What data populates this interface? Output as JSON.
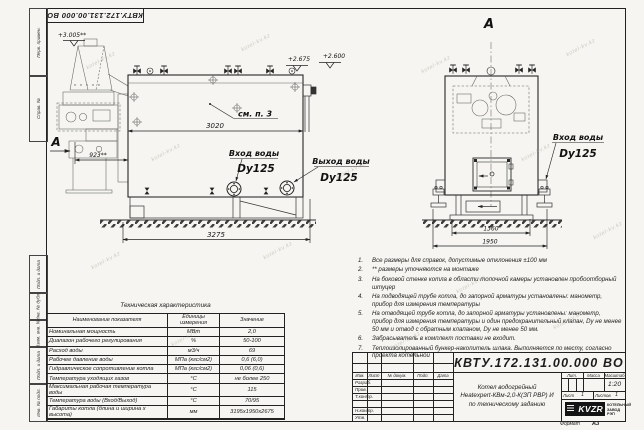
{
  "watermark": "kotel-kv.kz",
  "frame": {
    "left_labels": [
      "Перв. примен.",
      "Справ. №",
      "Подп. и дата",
      "Инв. № дубл.",
      "Взам. инв. №",
      "Подп. и дата",
      "Инв. № подл."
    ],
    "format_label": "Формат",
    "format_value": "А3"
  },
  "views": {
    "left": {
      "view_letter": "А",
      "dim_length": "3020",
      "dim_total": "3275",
      "dim_burner": "923**",
      "elev_hopper": "+3.005**",
      "elev_top": "+2.675",
      "elev_top2": "+2.600",
      "note_ref": "см. п. 3",
      "inlet": "Вход воды",
      "inlet_dn": "Dy125",
      "outlet": "Выход воды",
      "outlet_dn": "Dy125"
    },
    "right": {
      "title": "А",
      "dim_base": "1360",
      "dim_width": "1950",
      "inlet": "Вход воды",
      "inlet_dn": "Dy125"
    }
  },
  "notes": {
    "items": [
      {
        "num": "1.",
        "text": "Все размеры для справок, допустимые отклонения ±100 мм"
      },
      {
        "num": "2.",
        "text": "** размеры уточняются на монтаже"
      },
      {
        "num": "3.",
        "text": "На боковой стенке котла в области топочной камеры установлен пробоотборный штуцер"
      },
      {
        "num": "4.",
        "text": "На подводящей трубе котла, до запорной арматуры установлены: манометр, прибор для измерения температуры"
      },
      {
        "num": "5.",
        "text": "На отводящей трубе котла, до запорной арматуры установлены: манометр, прибор для измерения температуры и один предохранительный клапан, Dy не менее 50 мм и отвод с обратным клапаном, Dy не менее 50 мм."
      },
      {
        "num": "6.",
        "text": "Забрасыватель в комплект поставки не входит."
      },
      {
        "num": "7.",
        "text": "Теплоизолированный бункер-накопитель шлака. Выполняется по месту, согласно проекта котельной"
      }
    ]
  },
  "tech_table": {
    "title": "Техническая характеристика",
    "headers": [
      "Наименование показателя",
      "Единицы измерения",
      "Значение"
    ],
    "rows": [
      {
        "name": "Номинальная мощность",
        "unit": "МВт",
        "value": "2,0"
      },
      {
        "name": "Диапазон рабочего регулирования",
        "unit": "%",
        "value": "50-100"
      },
      {
        "name": "Расход воды",
        "unit": "м3/ч",
        "value": "69"
      },
      {
        "name": "Рабочее давление воды",
        "unit": "МПа (кгс/см2)",
        "value": "0,6 (6,0)"
      },
      {
        "name": "Гидравлическое сопротивление котла",
        "unit": "МПа (кгс/см2)",
        "value": "0,06 (0,6)"
      },
      {
        "name": "Температура уходящих газов",
        "unit": "°С",
        "value": "не более 250"
      },
      {
        "name": "Максимальная рабочая температура воды",
        "unit": "°С",
        "value": "115"
      },
      {
        "name": "Температура воды (Вход/Выход)",
        "unit": "°С",
        "value": "70/95"
      },
      {
        "name": "Габариты котла (длина и ширина х высота)",
        "unit": "мм",
        "value": "3195х1950х2675"
      }
    ]
  },
  "title_block": {
    "doc_number": "КВТУ.172.131.00.000 ВО",
    "rev_headers": [
      "Изм.",
      "Лист",
      "№ докум.",
      "Подп.",
      "Дата"
    ],
    "row_labels": [
      "Разраб.",
      "Пров.",
      "Т.контр.",
      "Н.контр.",
      "Утв."
    ],
    "product_line1": "Котел водогрейный",
    "product_line2": "Heatexpert-КВм-2,0-К(ЗП РВР) И",
    "product_line3": "по техническому заданию",
    "lit_label": "Лит.",
    "mass_label": "Масса",
    "scale_label": "Масштаб",
    "scale_value": "1:20",
    "sheet_label": "Лист",
    "sheet_value": "1",
    "sheets_label": "Листов",
    "sheets_value": "1",
    "logo_text": "KVZR",
    "company_line1": "КОТЕЛЬНЫЙ",
    "company_line2": "ЗАВОД РЭП"
  }
}
